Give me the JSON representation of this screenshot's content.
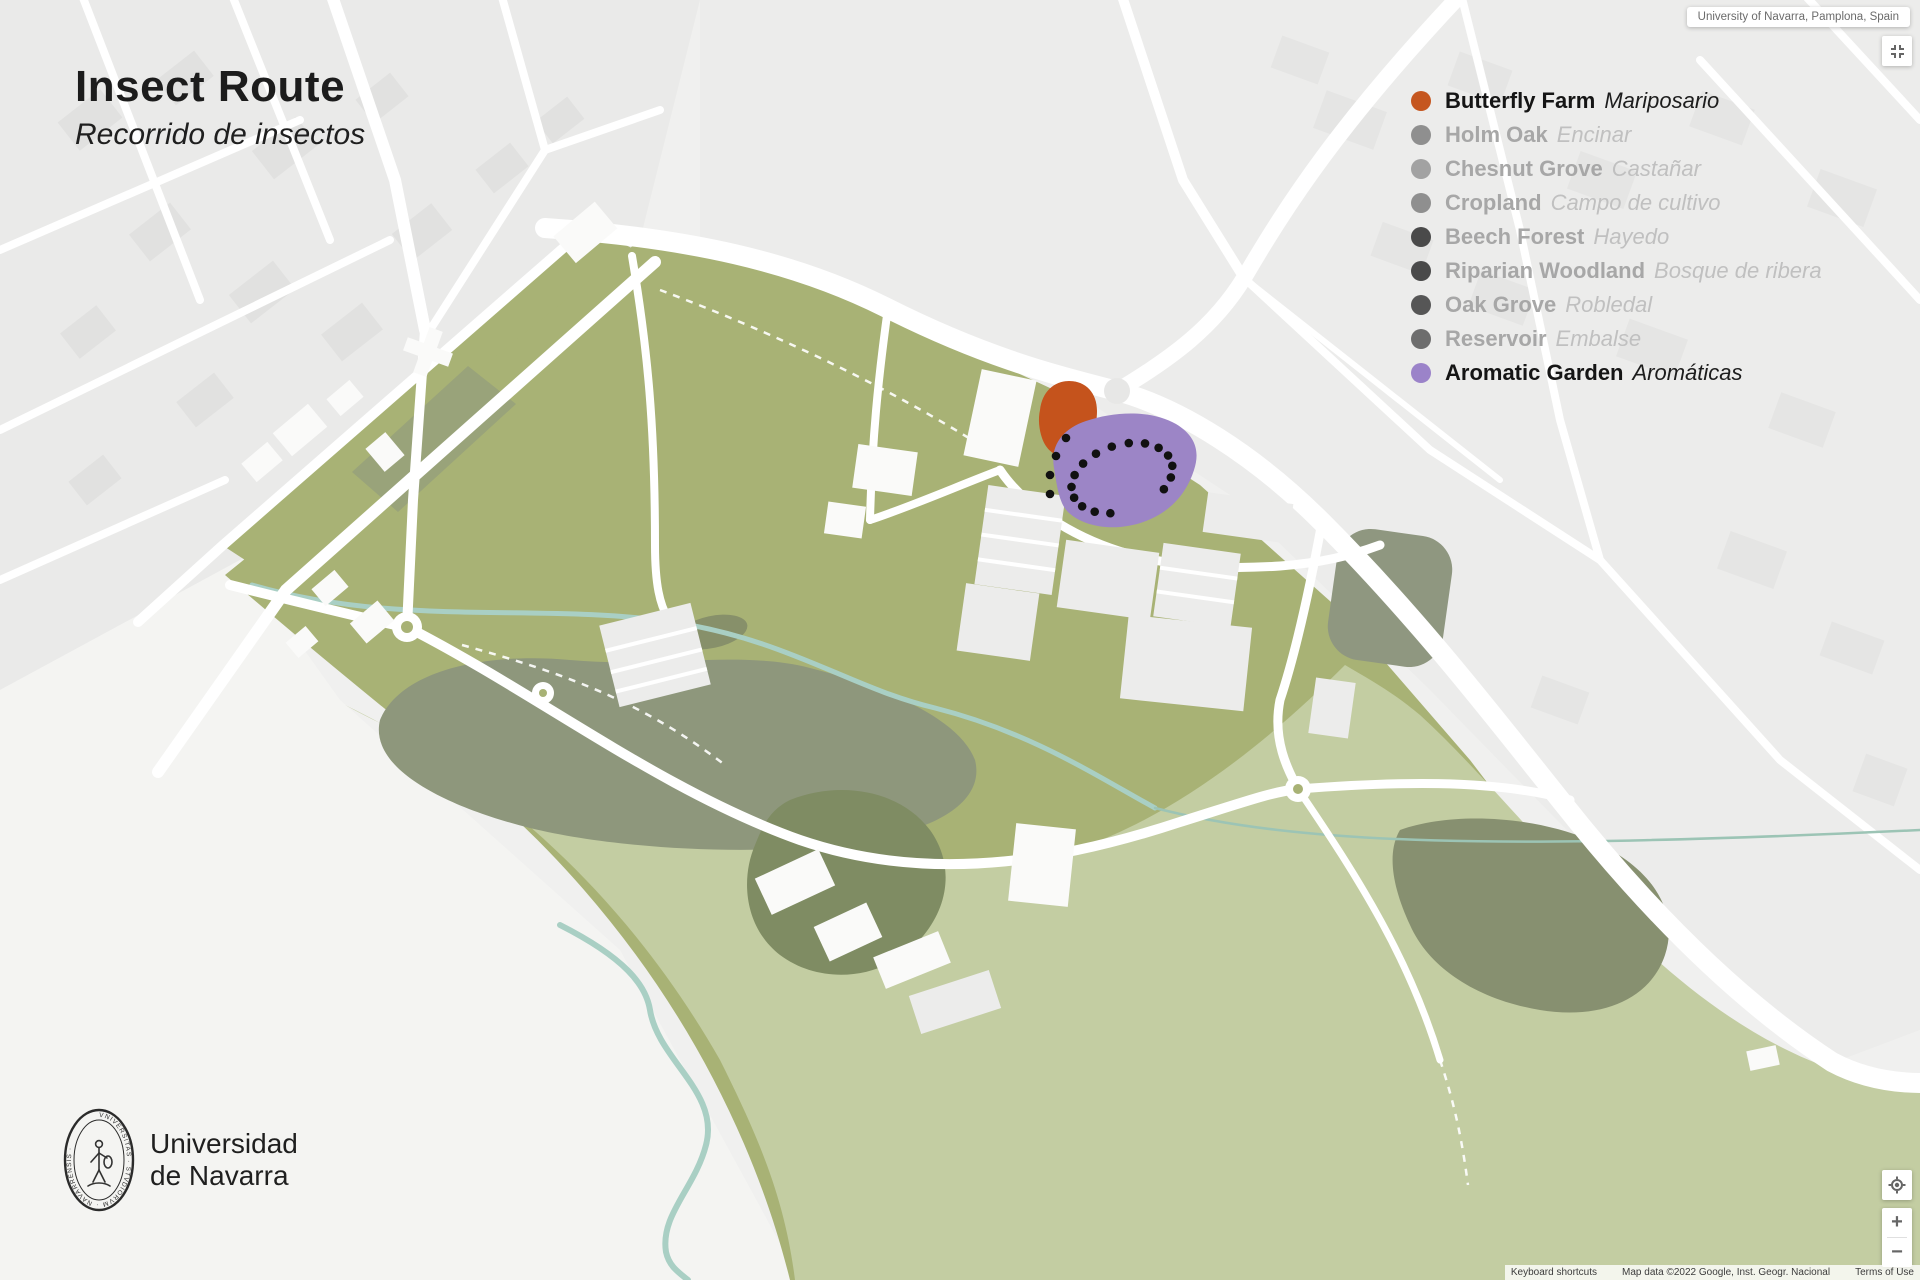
{
  "title": {
    "main": "Insect Route",
    "subtitle": "Recorrido de insectos"
  },
  "map_label": "University of Navarra, Pamplona, Spain",
  "legend": {
    "items": [
      {
        "label": "Butterfly Farm",
        "native": "Mariposario",
        "dot": "#c5561f",
        "active": true
      },
      {
        "label": "Holm Oak",
        "native": "Encinar",
        "dot": "#8f8f8f",
        "active": false
      },
      {
        "label": "Chesnut Grove",
        "native": "Castañar",
        "dot": "#a2a2a2",
        "active": false
      },
      {
        "label": "Cropland",
        "native": "Campo de cultivo",
        "dot": "#8f8f8f",
        "active": false
      },
      {
        "label": "Beech Forest",
        "native": "Hayedo",
        "dot": "#4a4a4a",
        "active": false
      },
      {
        "label": "Riparian Woodland",
        "native": "Bosque de ribera",
        "dot": "#4a4a4a",
        "active": false
      },
      {
        "label": "Oak Grove",
        "native": "Robledal",
        "dot": "#565656",
        "active": false
      },
      {
        "label": "Reservoir",
        "native": "Embalse",
        "dot": "#6d6d6d",
        "active": false
      },
      {
        "label": "Aromatic Garden",
        "native": "Aromáticas",
        "dot": "#9b83c9",
        "active": true
      }
    ]
  },
  "areas": {
    "butterfly_farm_color": "#c5531c",
    "aromatic_garden_color": "#9c85c6"
  },
  "route": {
    "color": "#111111",
    "dot_radius": 4.3,
    "loop": {
      "cx": 1122,
      "cy": 478,
      "rx": 52,
      "ry": 33,
      "rot_deg": -18,
      "count": 16,
      "start_deg": 115,
      "end_deg": 425
    },
    "tail": [
      [
        1066,
        438
      ],
      [
        1056,
        456
      ],
      [
        1050,
        475
      ],
      [
        1050,
        494
      ]
    ],
    "markers": [
      [
        1062,
        415
      ],
      [
        1113,
        547
      ]
    ]
  },
  "logo": {
    "line1": "Universidad",
    "line2": "de Navarra",
    "seal_text": "VNIVERSITAS · STVDIORVM · NAVARRENSIS ·"
  },
  "controls": {
    "zoom_in": "+",
    "zoom_out": "−"
  },
  "attribution": {
    "keyboard": "Keyboard shortcuts",
    "map_data": "Map data ©2022 Google, Inst. Geogr. Nacional",
    "terms": "Terms of Use"
  }
}
